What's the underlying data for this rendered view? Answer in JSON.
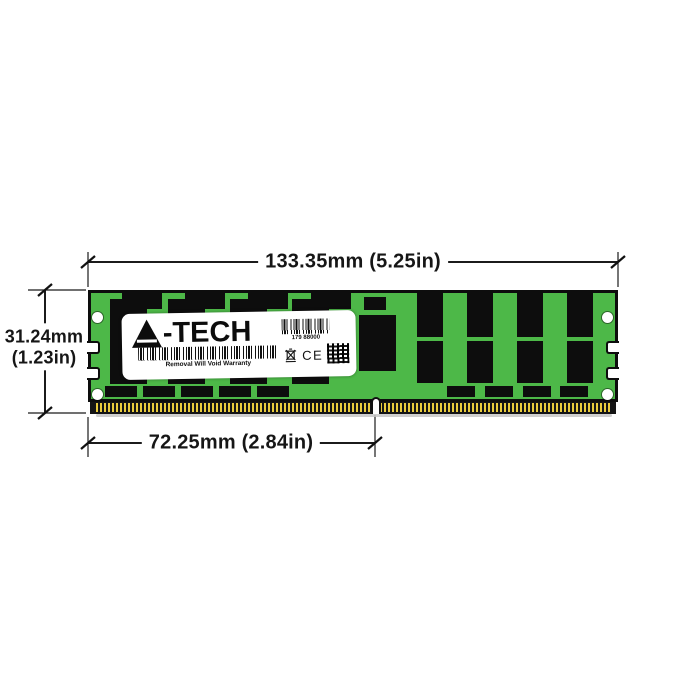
{
  "page": {
    "background": "#ffffff"
  },
  "dims": {
    "width": "133.35mm (5.25in)",
    "height_mm": "31.24mm",
    "height_in": "(1.23in)",
    "contact": "72.25mm (2.84in)"
  },
  "module": {
    "pcb_color": "#4db848",
    "chip_color": "#0d0d0d",
    "pin_gold_color": "#e9cb3d",
    "sticker": {
      "brand": "A-TECH",
      "brand_text": "-TECH",
      "serial": "179 88000",
      "warranty": "Removal Will Void Warranty",
      "ce": "CE"
    }
  },
  "icons": {
    "logo_triangle": "a-tech-triangle-logo",
    "serial_barcode": "barcode",
    "warranty_barcode": "barcode",
    "weee": "crossed-out-wheelie-bin",
    "qr": "qr-code"
  }
}
